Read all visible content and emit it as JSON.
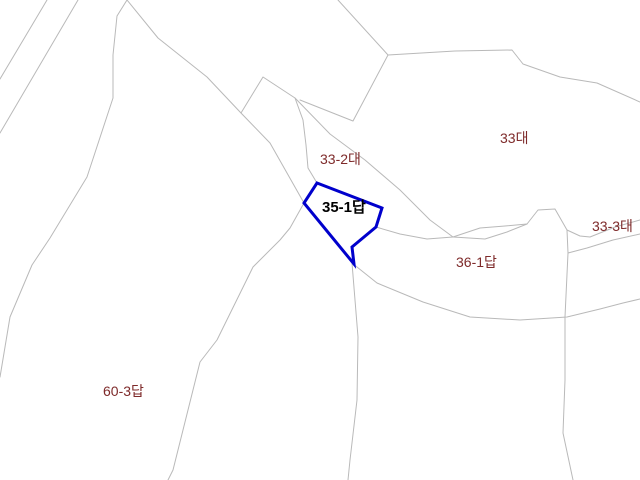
{
  "map": {
    "width": 640,
    "height": 480,
    "background_color": "#ffffff",
    "boundary_color": "#b9b9b9",
    "boundary_width": 1,
    "selected_outline_color": "#0000cc",
    "selected_outline_width": 3,
    "label_color": "#7e2a2a",
    "selected_label_color": "#000000",
    "boundaries": [
      {
        "id": "road-edge-west-1",
        "points": "47,0 0,79"
      },
      {
        "id": "road-edge-west-2",
        "points": "78,0 0,133"
      },
      {
        "id": "west-curve",
        "points": "127,0 117,16 113,55 113,98 87,177 50,238 32,265 10,317 0,377"
      },
      {
        "id": "strip-north",
        "points": "127,0 158,38 207,77 241,113 270,143 304,203"
      },
      {
        "id": "apex-diagonal",
        "points": "241,113 263,77 295,98 330,134 365,160 400,190 430,220 453,237"
      },
      {
        "id": "v-branch-to-top",
        "points": "300,100 353,121 388,55"
      },
      {
        "id": "curve-to-parcel-a",
        "points": "295,98 303,120 306,145 308,168 317,183"
      },
      {
        "id": "lens-upper",
        "points": "453,237 480,228 505,226 527,224"
      },
      {
        "id": "lens-lower",
        "points": "453,237 485,239 507,232 527,224"
      },
      {
        "id": "north-boundary-33",
        "points": "338,0 388,55 455,51 512,50 523,64 560,77 597,83 640,102"
      },
      {
        "id": "plateau-east",
        "points": "527,224 538,210 555,209 567,230 580,236 590,237 615,227 640,220"
      },
      {
        "id": "east-vertical",
        "points": "567,230 568,253 565,317 565,380 563,433 573,480"
      },
      {
        "id": "east-branch",
        "points": "568,253 587,248 613,240 640,234"
      },
      {
        "id": "south-curve-36-1",
        "points": "352,263 377,283 423,302 470,317 520,320 567,317 600,309 623,303 640,299"
      },
      {
        "id": "west-boundary-36-1",
        "points": "352,263 358,337 357,400 350,460 348,480"
      },
      {
        "id": "east-boundary-60-3",
        "points": "304,203 290,228 280,240 253,267 217,340 200,362 173,470 168,480"
      },
      {
        "id": "parcel-c-to-junction",
        "points": "376,227 400,234 427,239 453,237"
      }
    ],
    "selected_parcel": {
      "id": "35-1답",
      "points": "317,183 382,208 376,227 352,247 354,264 304,203"
    },
    "labels": [
      {
        "text": "33-2대",
        "x": 320,
        "y": 152,
        "selected": false
      },
      {
        "text": "33대",
        "x": 500,
        "y": 131,
        "selected": false
      },
      {
        "text": "33-3대",
        "x": 592,
        "y": 219,
        "selected": false
      },
      {
        "text": "35-1답",
        "x": 322,
        "y": 200,
        "selected": true
      },
      {
        "text": "36-1답",
        "x": 456,
        "y": 255,
        "selected": false
      },
      {
        "text": "60-3답",
        "x": 103,
        "y": 384,
        "selected": false
      }
    ]
  }
}
